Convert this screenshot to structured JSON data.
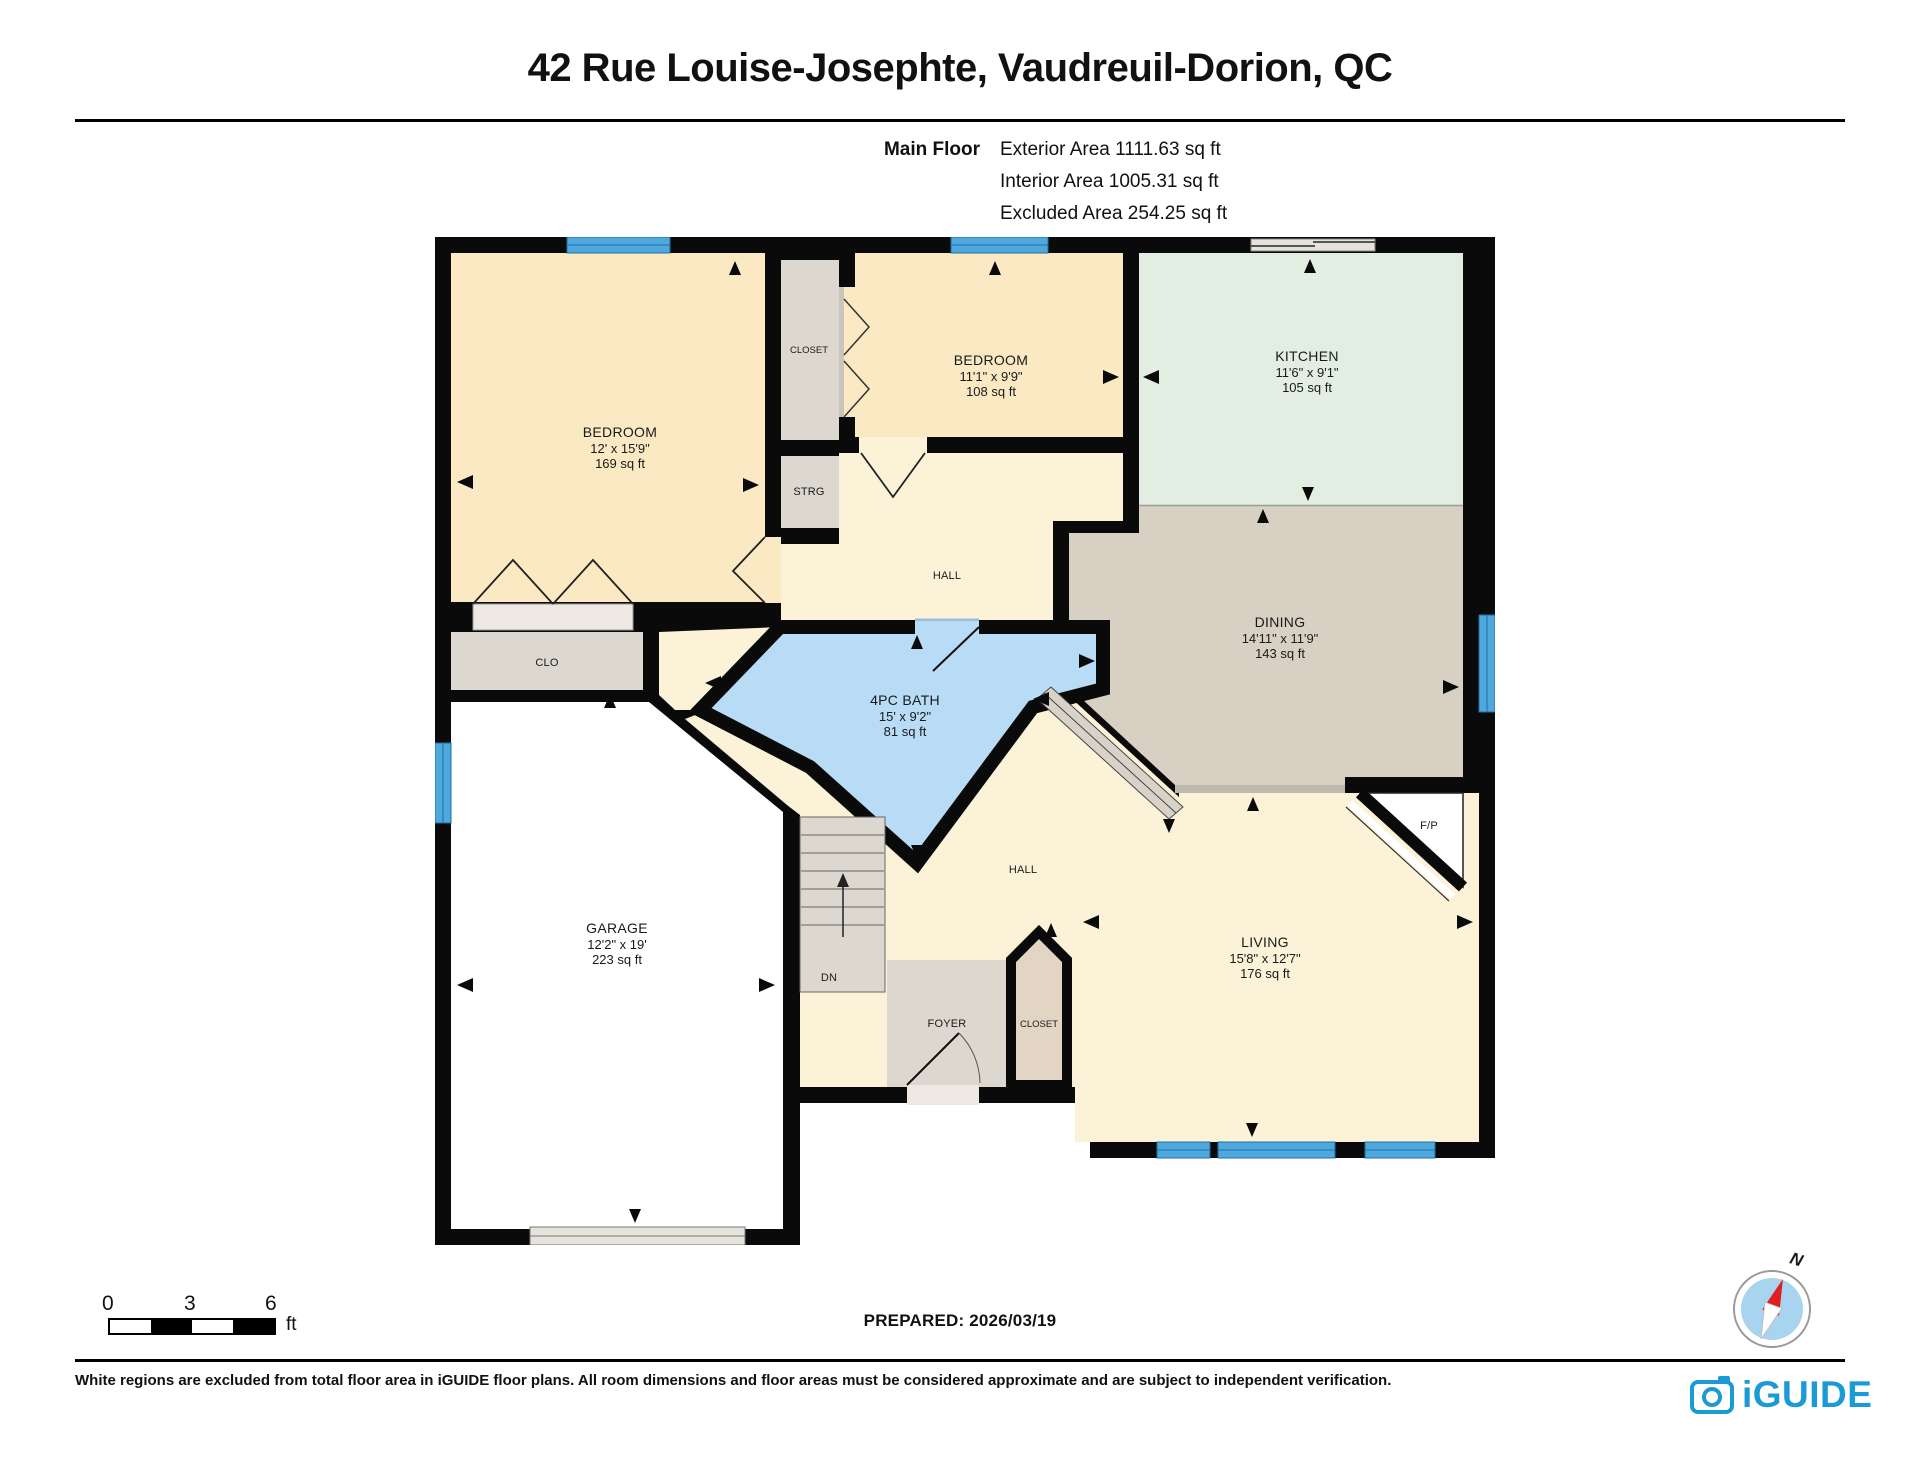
{
  "header": {
    "title": "42 Rue Louise-Josephte, Vaudreuil-Dorion, QC",
    "floor_label": "Main Floor",
    "areas": {
      "exterior": "Exterior Area 1111.63 sq ft",
      "interior": "Interior Area 1005.31 sq ft",
      "excluded": "Excluded Area 254.25 sq ft"
    }
  },
  "rooms": {
    "bedroom1": {
      "name": "BEDROOM",
      "dims": "12' x 15'9\"",
      "area": "169 sq ft"
    },
    "bedroom2": {
      "name": "BEDROOM",
      "dims": "11'1\" x 9'9\"",
      "area": "108 sq ft"
    },
    "kitchen": {
      "name": "KITCHEN",
      "dims": "11'6\" x 9'1\"",
      "area": "105 sq ft"
    },
    "dining": {
      "name": "DINING",
      "dims": "14'11\" x 11'9\"",
      "area": "143 sq ft"
    },
    "bath": {
      "name": "4PC BATH",
      "dims": "15' x 9'2\"",
      "area": "81 sq ft"
    },
    "garage": {
      "name": "GARAGE",
      "dims": "12'2\" x 19'",
      "area": "223 sq ft"
    },
    "living": {
      "name": "LIVING",
      "dims": "15'8\" x 12'7\"",
      "area": "176 sq ft"
    },
    "labels": {
      "closet": "CLOSET",
      "strg": "STRG",
      "clo": "CLO",
      "hall_upper": "HALL",
      "hall_lower": "HALL",
      "foyer": "FOYER",
      "entry_closet": "CLOSET",
      "dn": "DN",
      "fireplace": "F/P"
    }
  },
  "scale_bar": {
    "ticks": [
      "0",
      "3",
      "6"
    ],
    "unit": "ft"
  },
  "footer": {
    "prepared": "PREPARED: 2026/03/19",
    "compass_north": "N",
    "disclaimer": "White regions are excluded from total floor area in iGUIDE floor plans. All room dimensions and floor areas must be considered approximate and are subject to independent verification.",
    "brand": "iGUIDE"
  },
  "colors": {
    "wall": "#0a0a0a",
    "bedroom": "#fae9c3",
    "hall": "#fbf2d8",
    "kitchen": "#e3eee3",
    "dining": "#d8d1c3",
    "bath": "#b8dcf5",
    "closet_grey": "#dcd8d0",
    "entry_closet": "#e2d5c3",
    "window": "#4fa8dc",
    "brand_blue": "#1c9ad6",
    "compass_red": "#e02020"
  }
}
